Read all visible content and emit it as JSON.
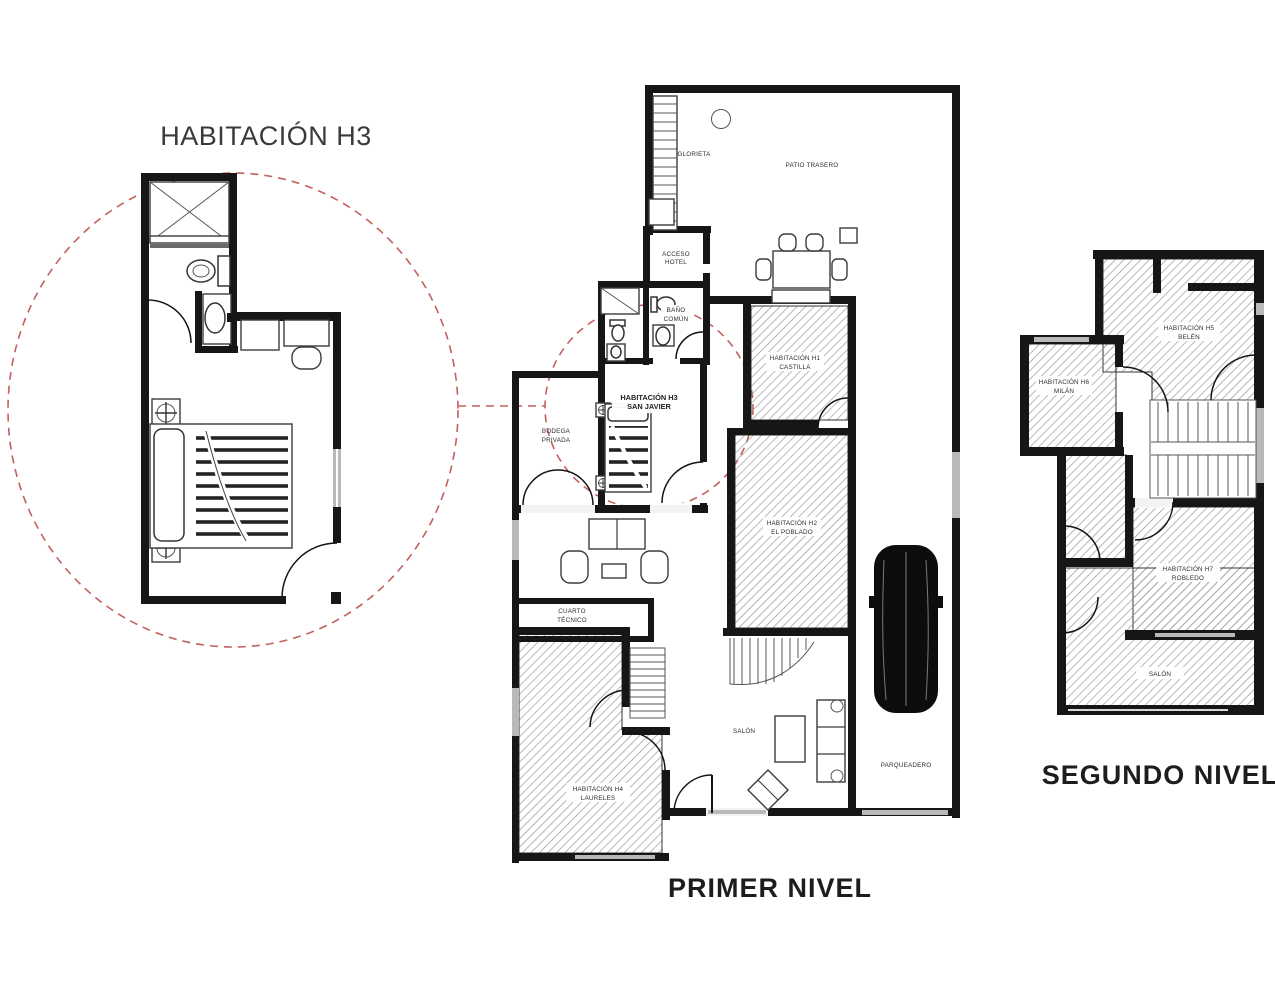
{
  "detail": {
    "title": "HABITACIÓN H3"
  },
  "primer": {
    "title": "PRIMER NIVEL",
    "rooms": {
      "glorieta": "GLORIETA",
      "patio": "PATIO TRASERO",
      "acceso": {
        "l1": "ACCESO",
        "l2": "HOTEL"
      },
      "bano": {
        "l1": "BAÑO",
        "l2": "COMÚN"
      },
      "h3": {
        "l1": "HABITACIÓN H3",
        "l2": "SAN JAVIER"
      },
      "bodega": {
        "l1": "BODEGA",
        "l2": "PRIVADA"
      },
      "castilla": {
        "l1": "HABITACIÓN H1",
        "l2": "CASTILLA"
      },
      "poblado": {
        "l1": "HABITACIÓN H2",
        "l2": "EL POBLADO"
      },
      "cuarto": {
        "l1": "CUARTO",
        "l2": "TÉCNICO"
      },
      "laureles": {
        "l1": "HABITACIÓN H4",
        "l2": "LAURELES"
      },
      "salon": "SALÓN",
      "parqueadero": "PARQUEADERO"
    }
  },
  "segundo": {
    "title": "SEGUNDO NIVEL",
    "rooms": {
      "belen": {
        "l1": "HABITACIÓN H5",
        "l2": "BELÉN"
      },
      "milan": {
        "l1": "HABITACIÓN H6",
        "l2": "MILÁN"
      },
      "robledo": {
        "l1": "HABITACIÓN H7",
        "l2": "ROBLEDO"
      },
      "salon": "SALÓN"
    }
  },
  "colors": {
    "wall": "#161616",
    "hatch": "#9a9a9a",
    "callout": "#c4605c",
    "window": "#b9b9b9",
    "text": "#333333"
  }
}
